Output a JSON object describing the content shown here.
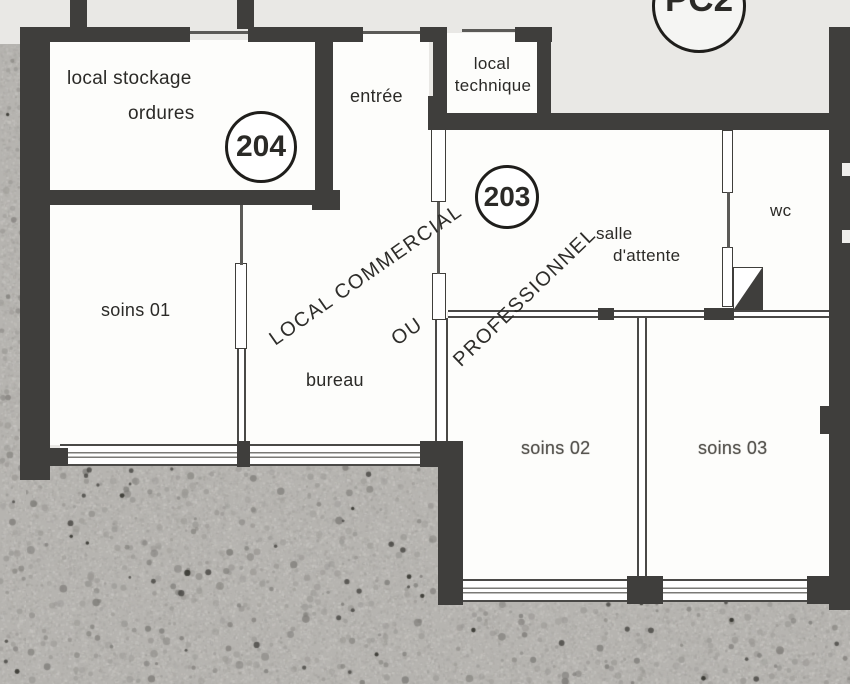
{
  "plan": {
    "title": "floor plan units 203-204",
    "labels": {
      "local_stockage_line1": "local stockage",
      "local_stockage_line2": "ordures",
      "unit_204": "204",
      "entree": "entrée",
      "local_technique_line1": "local",
      "local_technique_line2": "technique",
      "pc2": "PC2",
      "unit_203": "203",
      "diag_line1": "LOCAL  COMMERCIAL",
      "diag_line2": "OU",
      "diag_line3": "PROFESSIONNEL",
      "salle_line1": "salle",
      "salle_line2": "d'attente",
      "wc": "wc",
      "soins01": "soins 01",
      "bureau": "bureau",
      "soins02": "soins 02",
      "soins03": "soins 03"
    },
    "colors": {
      "paper": "#e9e8e5",
      "wall": "#3f3e3c",
      "room": "#fdfdfb",
      "concrete": "#b6b4b0",
      "ink": "#2b2a27"
    }
  }
}
